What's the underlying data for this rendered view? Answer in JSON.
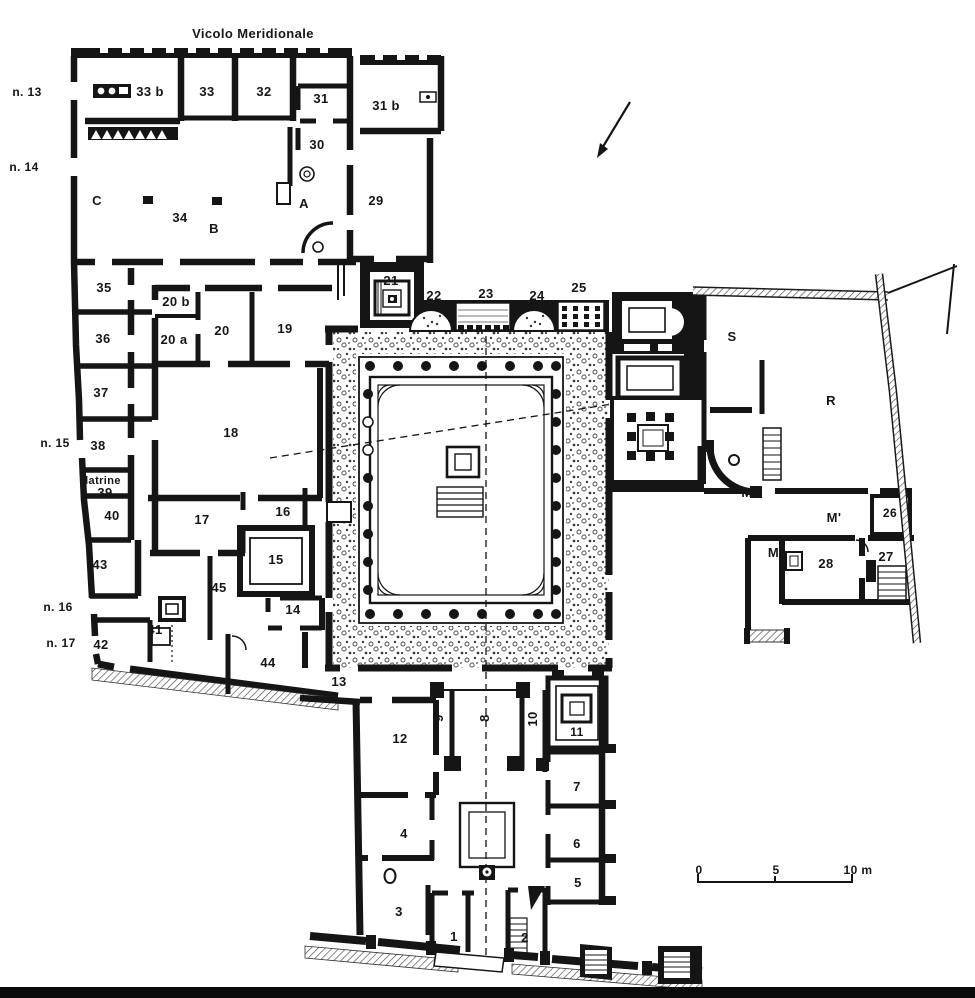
{
  "document": {
    "street_label": "Vicolo Meridionale",
    "scale_bar": {
      "tick_0": "0",
      "tick_5": "5",
      "tick_10": "10 m"
    },
    "ink_color": "#151515",
    "paper_color": "#ffffff"
  },
  "plan": {
    "labels": [
      {
        "id": "street-name",
        "text": "Vicolo Meridionale",
        "x": 253,
        "y": 38,
        "size": 13
      },
      {
        "id": "n13",
        "text": "n. 13",
        "x": 27,
        "y": 96,
        "size": 12
      },
      {
        "id": "n14",
        "text": "n. 14",
        "x": 24,
        "y": 171,
        "size": 12
      },
      {
        "id": "n15",
        "text": "n. 15",
        "x": 55,
        "y": 447,
        "size": 12
      },
      {
        "id": "n16",
        "text": "n. 16",
        "x": 58,
        "y": 611,
        "size": 12
      },
      {
        "id": "n17",
        "text": "n. 17",
        "x": 61,
        "y": 647,
        "size": 12
      },
      {
        "id": "latrine",
        "text": "latrine",
        "x": 103,
        "y": 484,
        "size": 11
      },
      {
        "id": "r33b",
        "text": "33 b",
        "x": 150,
        "y": 96,
        "size": 13
      },
      {
        "id": "r33",
        "text": "33",
        "x": 207,
        "y": 96,
        "size": 13
      },
      {
        "id": "r32",
        "text": "32",
        "x": 264,
        "y": 96,
        "size": 13
      },
      {
        "id": "r31",
        "text": "31",
        "x": 321,
        "y": 103,
        "size": 13
      },
      {
        "id": "r31b",
        "text": "31 b",
        "x": 386,
        "y": 110,
        "size": 13
      },
      {
        "id": "r30",
        "text": "30",
        "x": 317,
        "y": 149,
        "size": 13
      },
      {
        "id": "r29",
        "text": "29",
        "x": 376,
        "y": 205,
        "size": 13
      },
      {
        "id": "rC",
        "text": "C",
        "x": 97,
        "y": 205,
        "size": 13
      },
      {
        "id": "r34",
        "text": "34",
        "x": 180,
        "y": 222,
        "size": 13
      },
      {
        "id": "rB",
        "text": "B",
        "x": 214,
        "y": 233,
        "size": 13
      },
      {
        "id": "rA",
        "text": "A",
        "x": 304,
        "y": 208,
        "size": 13
      },
      {
        "id": "r35",
        "text": "35",
        "x": 104,
        "y": 292,
        "size": 13
      },
      {
        "id": "r36",
        "text": "36",
        "x": 103,
        "y": 343,
        "size": 13
      },
      {
        "id": "r37",
        "text": "37",
        "x": 101,
        "y": 397,
        "size": 13
      },
      {
        "id": "r38",
        "text": "38",
        "x": 98,
        "y": 450,
        "size": 13
      },
      {
        "id": "r39",
        "text": "39",
        "x": 105,
        "y": 497,
        "size": 13
      },
      {
        "id": "r40",
        "text": "40",
        "x": 112,
        "y": 520,
        "size": 13
      },
      {
        "id": "r43",
        "text": "43",
        "x": 100,
        "y": 569,
        "size": 13
      },
      {
        "id": "r42",
        "text": "42",
        "x": 101,
        "y": 649,
        "size": 13
      },
      {
        "id": "r41",
        "text": "41",
        "x": 155,
        "y": 634,
        "size": 13
      },
      {
        "id": "r44",
        "text": "44",
        "x": 268,
        "y": 667,
        "size": 13
      },
      {
        "id": "r45",
        "text": "45",
        "x": 219,
        "y": 592,
        "size": 13
      },
      {
        "id": "r20b",
        "text": "20 b",
        "x": 176,
        "y": 306,
        "size": 13
      },
      {
        "id": "r20a",
        "text": "20 a",
        "x": 174,
        "y": 344,
        "size": 13
      },
      {
        "id": "r20",
        "text": "20",
        "x": 222,
        "y": 335,
        "size": 13
      },
      {
        "id": "r19",
        "text": "19",
        "x": 285,
        "y": 333,
        "size": 13
      },
      {
        "id": "r18",
        "text": "18",
        "x": 231,
        "y": 437,
        "size": 13
      },
      {
        "id": "r17",
        "text": "17",
        "x": 202,
        "y": 524,
        "size": 13
      },
      {
        "id": "r16",
        "text": "16",
        "x": 283,
        "y": 516,
        "size": 13
      },
      {
        "id": "r15",
        "text": "15",
        "x": 276,
        "y": 564,
        "size": 13
      },
      {
        "id": "r14",
        "text": "14",
        "x": 293,
        "y": 614,
        "size": 13
      },
      {
        "id": "r13",
        "text": "13",
        "x": 339,
        "y": 686,
        "size": 13
      },
      {
        "id": "r21",
        "text": "21",
        "x": 391,
        "y": 285,
        "size": 13
      },
      {
        "id": "r22",
        "text": "22",
        "x": 434,
        "y": 300,
        "size": 13
      },
      {
        "id": "r23",
        "text": "23",
        "x": 486,
        "y": 298,
        "size": 13
      },
      {
        "id": "r24",
        "text": "24",
        "x": 537,
        "y": 300,
        "size": 13
      },
      {
        "id": "r25",
        "text": "25",
        "x": 579,
        "y": 292,
        "size": 13
      },
      {
        "id": "rS",
        "text": "S",
        "x": 732,
        "y": 341,
        "size": 13
      },
      {
        "id": "rR",
        "text": "R",
        "x": 831,
        "y": 405,
        "size": 13
      },
      {
        "id": "rM",
        "text": "M",
        "x": 747,
        "y": 497,
        "size": 13
      },
      {
        "id": "rM1",
        "text": "M'",
        "x": 834,
        "y": 522,
        "size": 13
      },
      {
        "id": "rM2",
        "text": "M''",
        "x": 777,
        "y": 557,
        "size": 13
      },
      {
        "id": "r26",
        "text": "26",
        "x": 890,
        "y": 517,
        "size": 12
      },
      {
        "id": "r27",
        "text": "27",
        "x": 886,
        "y": 561,
        "size": 13
      },
      {
        "id": "r28",
        "text": "28",
        "x": 826,
        "y": 568,
        "size": 13
      },
      {
        "id": "r12",
        "text": "12",
        "x": 400,
        "y": 743,
        "size": 13
      },
      {
        "id": "r9",
        "text": "9",
        "x": 443,
        "y": 718,
        "size": 13,
        "rotate": -90
      },
      {
        "id": "r8",
        "text": "8",
        "x": 489,
        "y": 718,
        "size": 13,
        "rotate": -90
      },
      {
        "id": "r10",
        "text": "10",
        "x": 537,
        "y": 719,
        "size": 13,
        "rotate": -90
      },
      {
        "id": "r11",
        "text": "11",
        "x": 577,
        "y": 736,
        "size": 12
      },
      {
        "id": "r7",
        "text": "7",
        "x": 577,
        "y": 791,
        "size": 13
      },
      {
        "id": "r6",
        "text": "6",
        "x": 577,
        "y": 848,
        "size": 13
      },
      {
        "id": "r5",
        "text": "5",
        "x": 578,
        "y": 887,
        "size": 13
      },
      {
        "id": "r4",
        "text": "4",
        "x": 404,
        "y": 838,
        "size": 13
      },
      {
        "id": "r3",
        "text": "3",
        "x": 399,
        "y": 916,
        "size": 13
      },
      {
        "id": "r1",
        "text": "1",
        "x": 454,
        "y": 941,
        "size": 13
      },
      {
        "id": "r2",
        "text": "2",
        "x": 525,
        "y": 942,
        "size": 13
      },
      {
        "id": "scale0",
        "text": "0",
        "x": 699,
        "y": 874,
        "size": 12
      },
      {
        "id": "scale5",
        "text": "5",
        "x": 776,
        "y": 874,
        "size": 12
      },
      {
        "id": "scale10",
        "text": "10 m",
        "x": 858,
        "y": 874,
        "size": 12
      }
    ]
  }
}
